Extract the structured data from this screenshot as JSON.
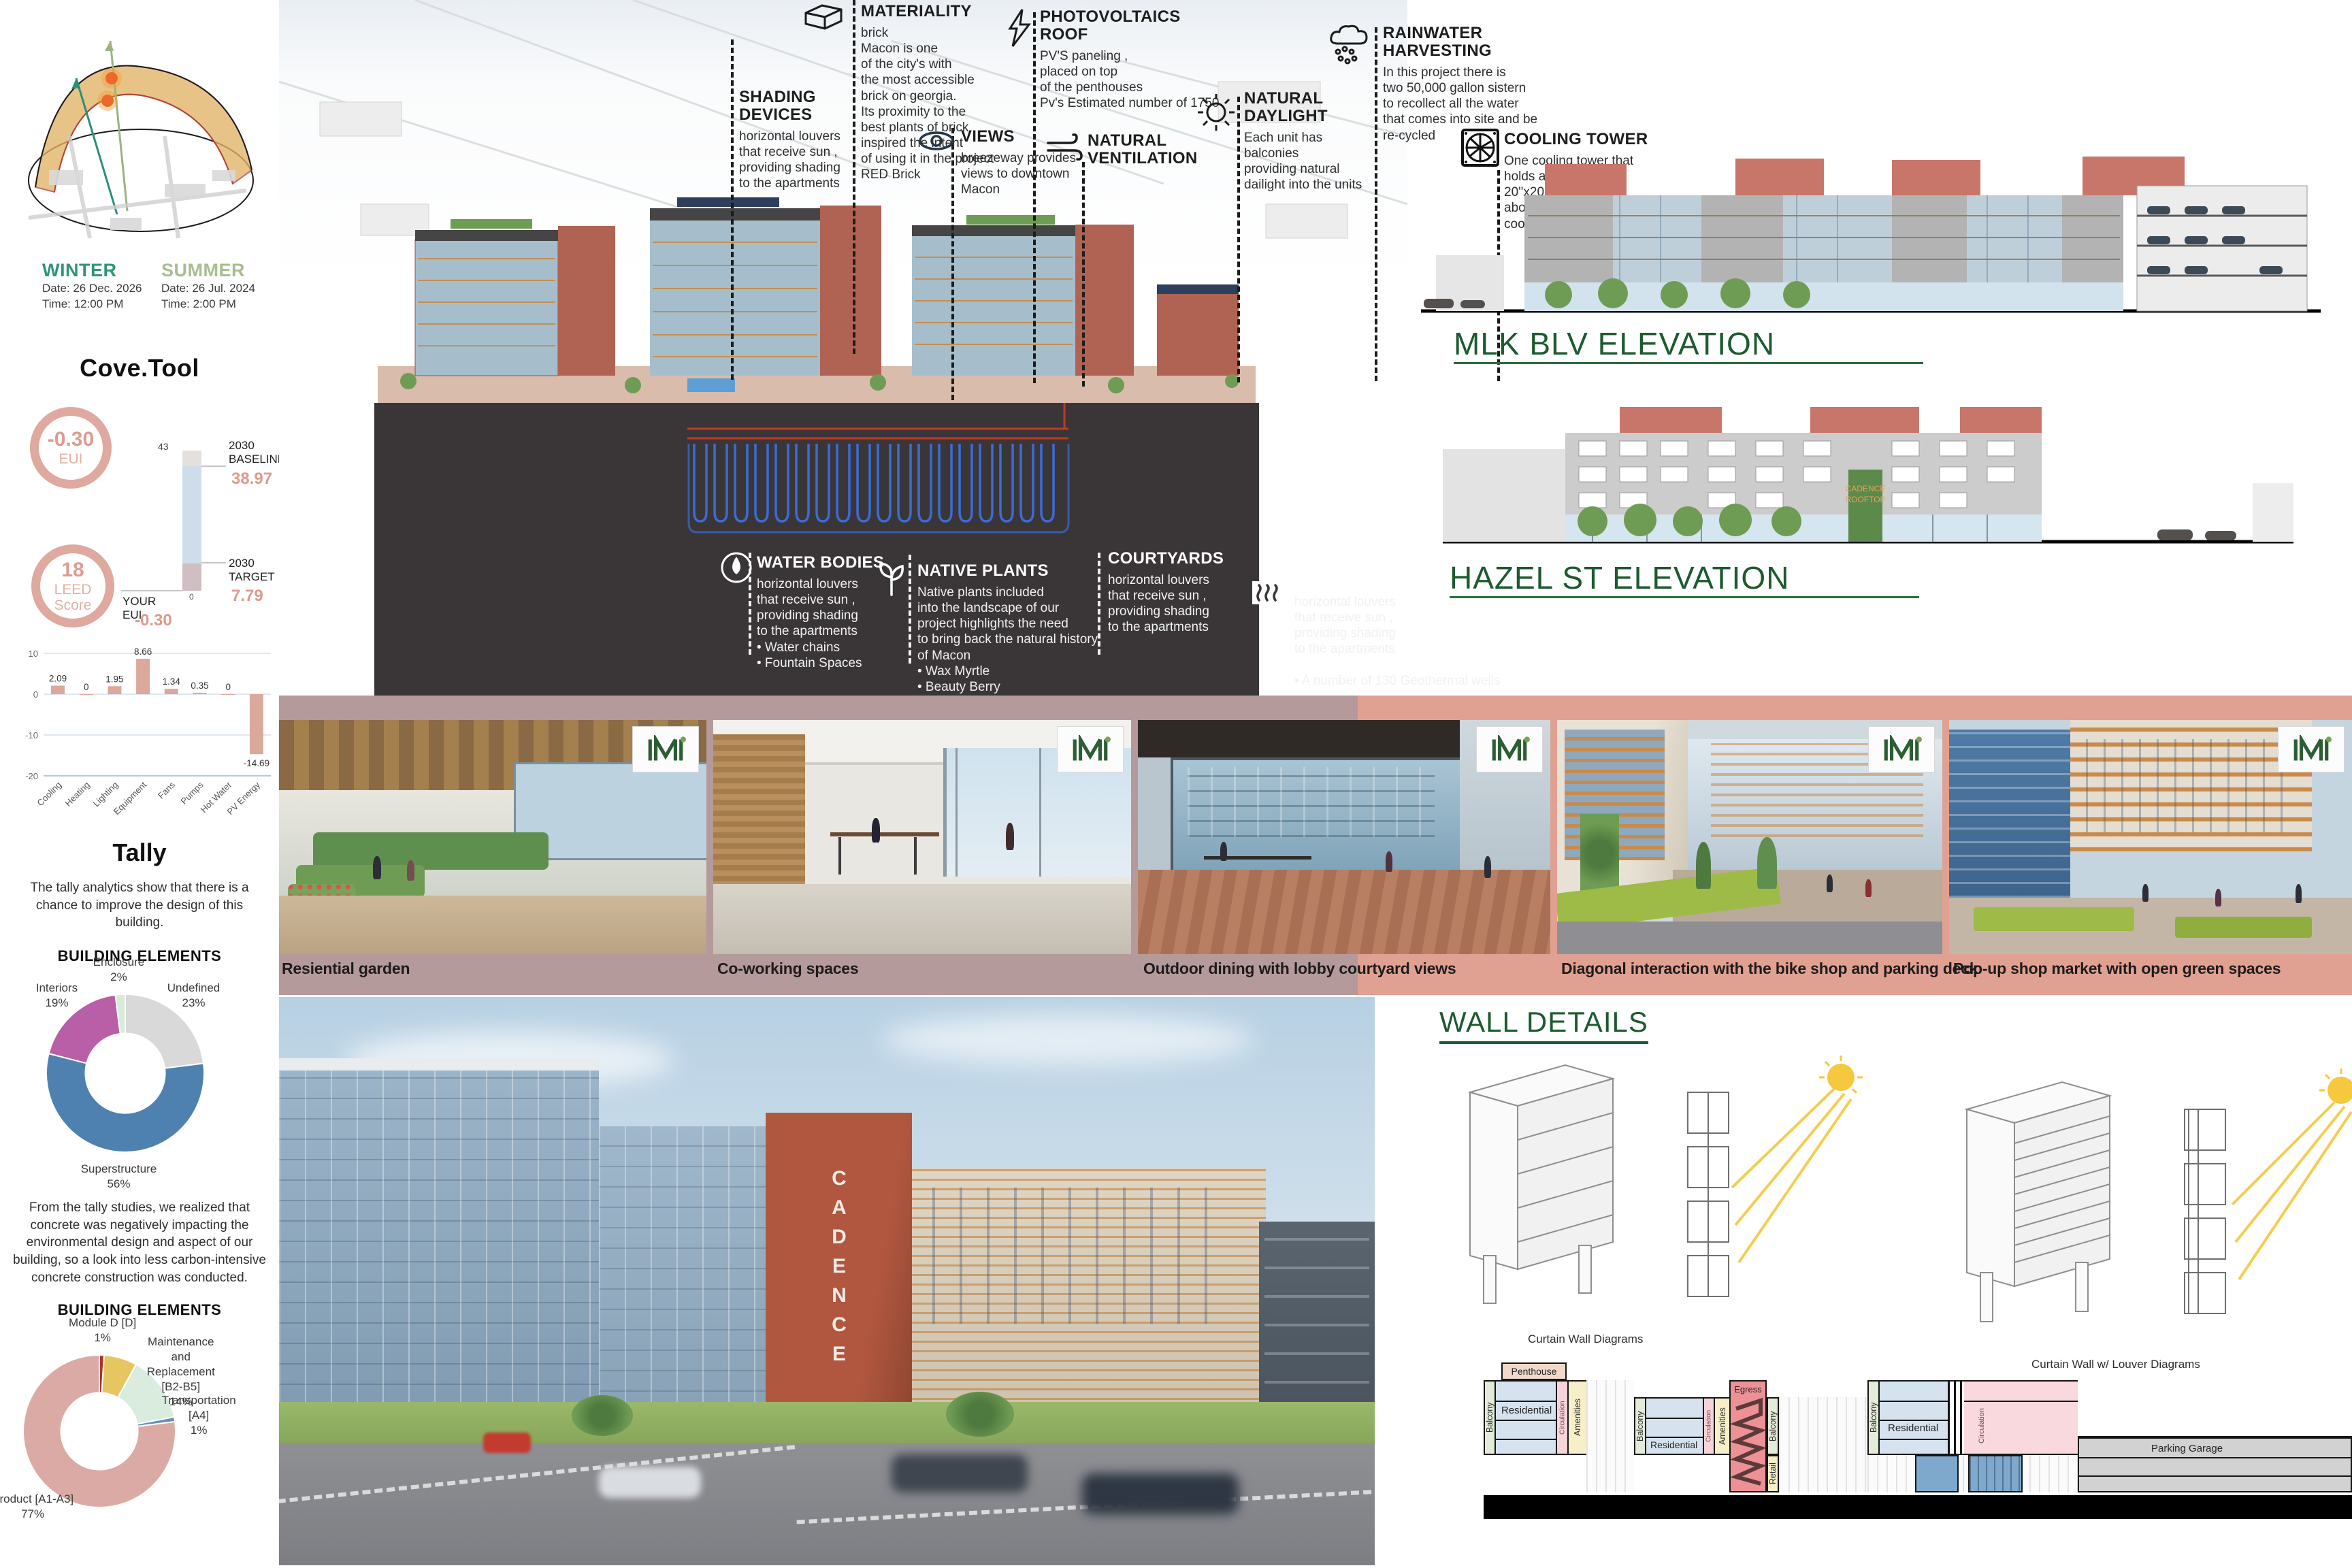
{
  "colors": {
    "green_heading": "#1d5a2f",
    "salmon_accent": "#dfa79a",
    "dark_panel": "#3a3637",
    "band_left": "#b49a9b",
    "band_right": "#e0a192",
    "winter_teal": "#2f9478",
    "summer_sage": "#a9bd90"
  },
  "sun_study": {
    "winter": {
      "label": "WINTER",
      "date": "Date: 26 Dec. 2026",
      "time": "Time: 12:00 PM"
    },
    "summer": {
      "label": "SUMMER",
      "date": "Date: 26 Jul. 2024",
      "time": "Time: 2:00 PM"
    }
  },
  "cove_tool": {
    "title": "Cove.Tool",
    "eui_ring": {
      "value": "-0.30",
      "label": "EUI"
    },
    "leed_ring": {
      "value": "18",
      "label": "LEED",
      "label2": "Score"
    },
    "benchmark": {
      "top_value": "43",
      "baseline_label": "2030\nBASELINE",
      "baseline_value": "38.97",
      "target_label": "2030\nTARGET",
      "target_value": "7.79",
      "your_label": "YOUR EUI",
      "your_value": "-0.30",
      "zero": "0"
    }
  },
  "tally": {
    "title": "Tally",
    "paragraph1": "The tally analytics show that there is a chance to improve the design of this building.",
    "paragraph2": "From the tally studies, we realized that concrete was negatively impacting the environmental design and aspect of our building, so a look into less carbon-intensive concrete construction was conducted.",
    "building_elements_heading": "BUILDING ELEMENTS"
  },
  "chart_data": [
    {
      "id": "energy_end_use",
      "type": "bar",
      "title": "",
      "categories": [
        "Cooling",
        "Heating",
        "Lighting",
        "Equipment",
        "Fans",
        "Pumps",
        "Hot Water",
        "PV Energy"
      ],
      "values": [
        2.09,
        0,
        1.95,
        8.66,
        1.34,
        0.35,
        0,
        -14.69
      ],
      "ylim": [
        -20,
        10
      ],
      "yticks": [
        10,
        0,
        -10,
        -20
      ],
      "bar_color": "#dba89c",
      "grid": true,
      "legend": "none"
    },
    {
      "id": "building_elements_1",
      "type": "donut",
      "title": "BUILDING ELEMENTS",
      "slices": [
        {
          "label": "Undefined",
          "pct": 23,
          "color": "#d9d9d9"
        },
        {
          "label": "Superstructure",
          "pct": 56,
          "color": "#4e81b0"
        },
        {
          "label": "Interiors",
          "pct": 19,
          "color": "#b85fa8"
        },
        {
          "label": "Enclosure",
          "pct": 2,
          "color": "#d5ecd9"
        }
      ]
    },
    {
      "id": "building_elements_2",
      "type": "donut",
      "title": "BUILDING ELEMENTS",
      "slices": [
        {
          "label": "Module D [D]",
          "pct": 1,
          "color": "#ab3428"
        },
        {
          "label": "",
          "pct": 7,
          "color": "#e6c661"
        },
        {
          "label": "Maintenance and Replacement [B2-B5]",
          "pct": 14,
          "color": "#d9ecdd"
        },
        {
          "label": "Transportation [A4]",
          "pct": 1,
          "color": "#6b8fb5"
        },
        {
          "label": "Product [A1-A3]",
          "pct": 77,
          "color": "#dcaaa4"
        }
      ]
    }
  ],
  "axon": {
    "callouts_top": [
      {
        "icon": "brick-icon",
        "title": "MATERIALITY",
        "body": "brick\nMacon is one\nof the city's with\nthe most accessible\nbrick on georgia.\nIts proximity to the\nbest plants of brick\ninspired the intent\nof using it in the project\nRED Brick"
      },
      {
        "icon": "lightning-icon",
        "title": "PHOTOVOLTAICS\nROOF",
        "body": "PV'S paneling ,\nplaced on top\nof the penthouses\nPv's Estimated number of 1750"
      },
      {
        "icon": "rain-cloud-icon",
        "title": "RAINWATER\nHARVESTING",
        "body": "In this project there is\ntwo 50,000 gallon sistern\nto recollect all the water\nthat comes into site and be\nre-cycled"
      },
      {
        "icon": "",
        "title": "SHADING\nDEVICES",
        "body": "horizontal louvers\nthat receive sun ,\nproviding shading\nto the apartments"
      },
      {
        "icon": "eye-icon",
        "title": "VIEWS",
        "body": "breezeway provides\nviews to downtown\nMacon"
      },
      {
        "icon": "wind-icon",
        "title": "NATURAL\nVENTILATION",
        "body": ""
      },
      {
        "icon": "sun-icon",
        "title": "NATURAL\nDAYLIGHT",
        "body": "Each unit has\nbalconies\nproviding natural\ndailight into the units"
      },
      {
        "icon": "fan-icon",
        "title": "COOLING TOWER",
        "body": "One cooling tower that\nholds around\n20''x20 cooling tower\nabout 750 tons of\ncooling capacity"
      }
    ],
    "callouts_bottom": [
      {
        "icon": "water-drop-icon",
        "title": "WATER BODIES",
        "body": "horizontal louvers\nthat receive sun ,\nproviding shading\nto the apartments\n•     Water chains\n•     Fountain Spaces"
      },
      {
        "icon": "plant-icon",
        "title": "NATIVE PLANTS",
        "body": "Native plants included\ninto the landscape of our\nproject highlights the need\nto bring back the natural history\nof Macon\n•     Wax Myrtle\n•     Beauty Berry\n•     Black Susan"
      },
      {
        "icon": "",
        "title": "COURTYARDS",
        "body": "horizontal louvers\nthat receive sun ,\nproviding shading\nto the apartments"
      },
      {
        "icon": "geothermal-icon",
        "title": "GEOTHERMAL WELLS",
        "body": "horizontal louvers\nthat receive sun ,\nproviding shading\nto the apartments\n\n•     A number of 130 Geothermal wells"
      }
    ]
  },
  "elevations": {
    "mlk_label": "MLK BLV ELEVATION",
    "hazel_label": "HAZEL ST ELEVATION",
    "hazel_sign": "CADENCE\nROOFTOP"
  },
  "renders": [
    {
      "caption": "Resiential garden"
    },
    {
      "caption": "Co-working spaces"
    },
    {
      "caption": "Outdoor dining with lobby courtyard views"
    },
    {
      "caption": "Diagonal interaction with the bike shop and parking deck"
    },
    {
      "caption": "Pop-up shop market with open green spaces"
    }
  ],
  "street_render": {
    "tower_sign": "CADENCE"
  },
  "wall_details": {
    "title": "WALL DETAILS",
    "label_left": "Curtain Wall Diagrams",
    "label_right": "Curtain Wall w/ Louver Diagrams",
    "section_labels": {
      "penthouse": "Penthouse",
      "residential": "Residential",
      "balcony": "Balcony",
      "circulation": "Circulation",
      "amenities": "Amenities",
      "egress": "Egress",
      "retail": "Retail",
      "parking": "Parking Garage"
    }
  }
}
